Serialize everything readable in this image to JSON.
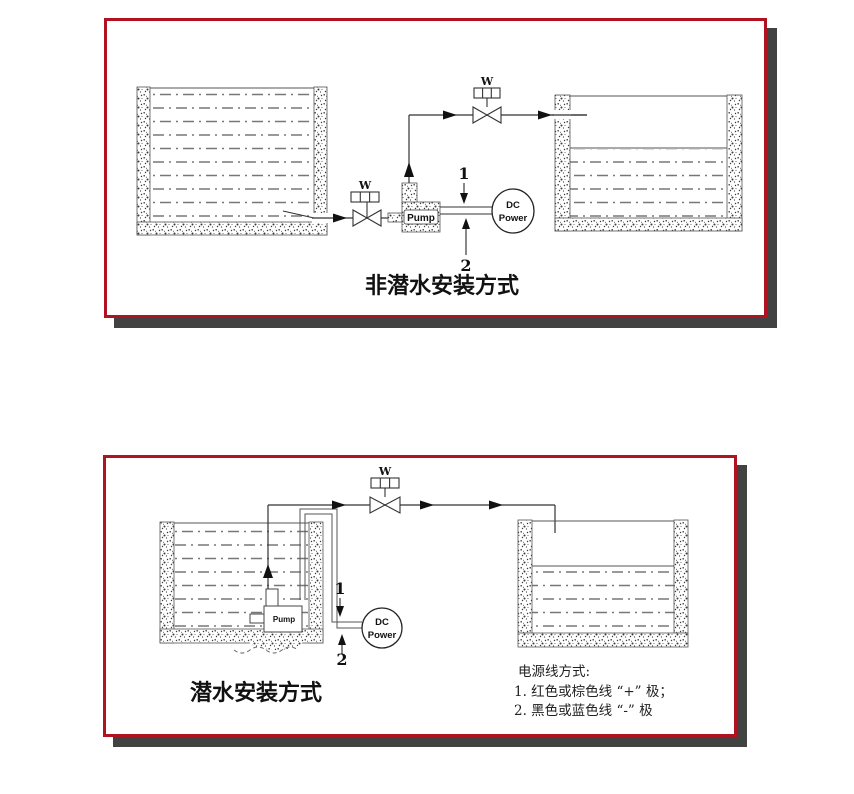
{
  "colors": {
    "panel_border": "#b01220",
    "panel_shadow": "#424242",
    "line": "#2a2a2a",
    "water_dash": "#777777",
    "stipple": "#3a3a3a"
  },
  "top_panel": {
    "title": "非潜水安装方式",
    "inlet_valve_label": "W",
    "outlet_valve_label": "W",
    "pump_label": "Pump",
    "dc_power": {
      "line1": "DC",
      "line2": "Power"
    },
    "wire_labels": {
      "positive": "1",
      "negative": "2"
    }
  },
  "bottom_panel": {
    "title": "潜水安装方式",
    "valve_label": "W",
    "pump_label": "Pump",
    "dc_power": {
      "line1": "DC",
      "line2": "Power"
    },
    "wire_labels": {
      "positive": "1",
      "negative": "2"
    },
    "power_line_notes": {
      "heading": "电源线方式:",
      "item1": "1. 红色或棕色线 “+” 极；",
      "item2": "2. 黑色或蓝色线 “-” 极"
    }
  }
}
